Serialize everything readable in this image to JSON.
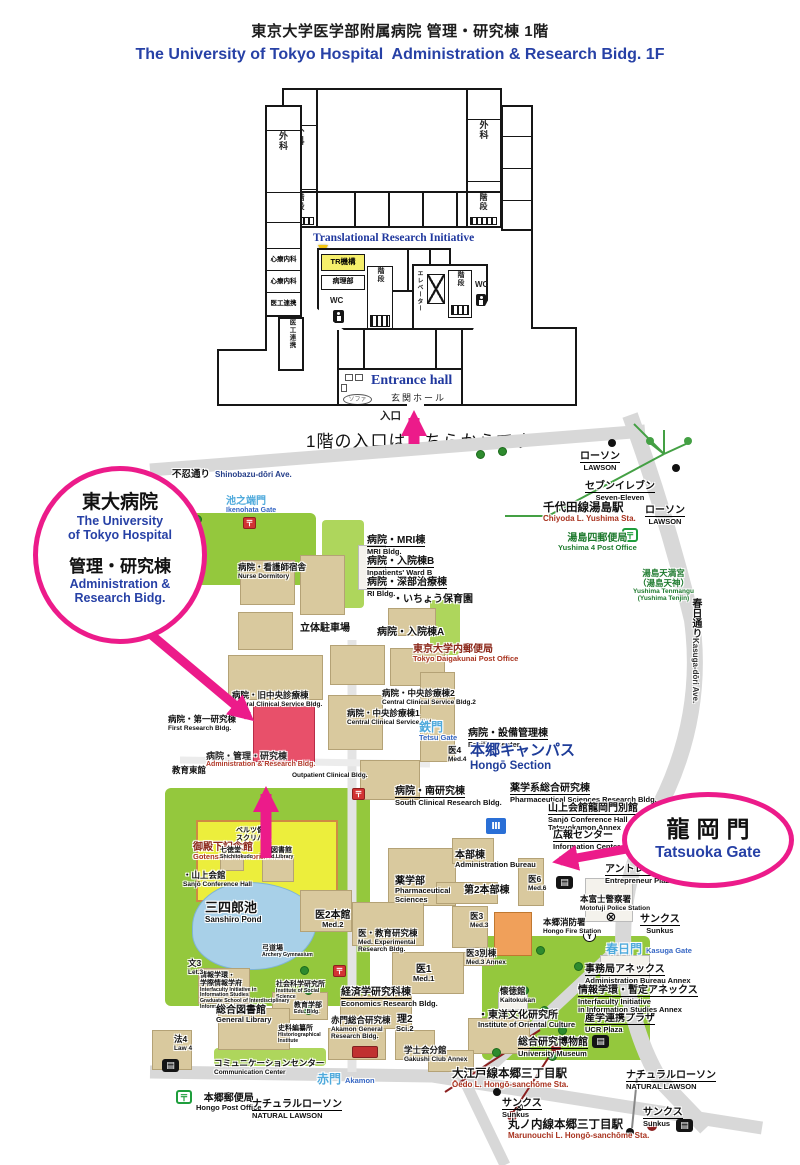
{
  "header": {
    "title_jp": "東京大学医学部附属病院 管理・研究棟 1階",
    "title_en": "The University of Tokyo Hospital  Administration & Research Bidg. 1F"
  },
  "colors": {
    "annotation_pink": "#EC1B8A",
    "highlight_red": "#E8506A",
    "title_blue": "#2741A6",
    "campus_blue": "#1F3D99",
    "gate_lightblue": "#4FAADC"
  },
  "floorplan": {
    "surgery": "外科",
    "stairs": "階段",
    "psychosomatic": "心療内科",
    "med_eng": "医工連携",
    "tri_label": "Translational Research Initiative",
    "tr_room": "TR機構",
    "pathology": "病理部",
    "wc": "WC",
    "elevator": "エレベーター",
    "entrance_en": "Entrance hall",
    "entrance_jp": "玄関ホール",
    "sofa": "ソファ",
    "entry": "入口",
    "note": "1階の入口はこちらからです"
  },
  "annotations": {
    "hospital": {
      "jp1": "東大病院",
      "en1": "The University\nof Tokyo Hospital",
      "jp2": "管理・研究棟",
      "en2": "Administration &\nResearch Bidg."
    },
    "gate": {
      "jp": "龍岡門",
      "en": "Tatsuoka Gate"
    }
  },
  "map": {
    "labels": [
      {
        "jp": "不忍通り",
        "en": "Shinobazu-dōri Ave.",
        "x": 172,
        "y": 464,
        "cls": "road-inline"
      },
      {
        "jp": "ローソン",
        "en": "LAWSON",
        "x": 580,
        "y": 446,
        "cls": "u center"
      },
      {
        "jp": "セブンイレブン",
        "en": "Seven-Eleven",
        "x": 585,
        "y": 476,
        "cls": "u center"
      },
      {
        "jp": "ローソン",
        "en": "LAWSON",
        "x": 645,
        "y": 500,
        "cls": "u center"
      },
      {
        "jp": "千代田線湯島駅",
        "en": "Chiyoda L. Yushima Sta.",
        "x": 543,
        "y": 502,
        "cls": "sta gline"
      },
      {
        "jp": "池之端門",
        "en": "Ikenohata Gate",
        "x": 226,
        "y": 496,
        "cls": "gate-sm"
      },
      {
        "jp": "湯島四郵便局",
        "en": "Yushima 4 Post Office",
        "x": 558,
        "y": 533,
        "cls": "g center"
      },
      {
        "jp": "湯島天満宮\n（湯島天神）",
        "en": "Yushima Tenmangu\n(Yushima Tenjin)",
        "x": 633,
        "y": 569,
        "cls": "g center sm"
      },
      {
        "jp": "春日通り",
        "en": "Kasuga-dōri Ave.",
        "x": 686,
        "y": 598,
        "cls": "vroad"
      },
      {
        "jp": "病院・看護師宿舎",
        "en": "Nurse Dormitory",
        "x": 238,
        "y": 563,
        "cls": "sm"
      },
      {
        "jp": "病院・MRI棟",
        "en": "MRI Bldg.",
        "x": 367,
        "y": 530,
        "cls": "u"
      },
      {
        "jp": "病院・入院棟B",
        "en": "Inpatients' Ward B",
        "x": 367,
        "y": 551,
        "cls": "u"
      },
      {
        "jp": "病院・深部治療棟",
        "en": "RI Bldg.",
        "x": 367,
        "y": 572,
        "cls": "u"
      },
      {
        "jp": "・いちょう保育園",
        "en": "",
        "x": 393,
        "y": 594,
        "cls": ""
      },
      {
        "jp": "立体駐車場",
        "en": "",
        "x": 300,
        "y": 623,
        "cls": ""
      },
      {
        "jp": "病院・入院棟A",
        "en": "",
        "x": 377,
        "y": 627,
        "cls": ""
      },
      {
        "jp": "東京大学内郵便局",
        "en": "Tokyo Daigakunai Post Office",
        "x": 413,
        "y": 644,
        "cls": "dr"
      },
      {
        "jp": "病院・旧中央診療棟",
        "en": "Central Clinical Service Bldg.",
        "x": 232,
        "y": 691,
        "cls": "sm"
      },
      {
        "jp": "病院・第一研究棟",
        "en": "First Research Bldg.",
        "x": 168,
        "y": 715,
        "cls": "sm"
      },
      {
        "jp": "病院・中央診療棟2",
        "en": "Central Clinical Service Bldg.2",
        "x": 382,
        "y": 689,
        "cls": "sm"
      },
      {
        "jp": "病院・中央診療棟1",
        "en": "Central Clinical Service Bldg.",
        "x": 347,
        "y": 709,
        "cls": "sm"
      },
      {
        "jp": "鉄門",
        "en": "Tetsu Gate",
        "x": 419,
        "y": 721,
        "cls": "gate"
      },
      {
        "jp": "病院・設備管理棟",
        "en": "Facility Center",
        "x": 468,
        "y": 723,
        "cls": "u"
      },
      {
        "jp": "医4",
        "en": "Med.4",
        "x": 448,
        "y": 746,
        "cls": "sm"
      },
      {
        "jp": "本郷キャンパス",
        "en": "Hongō Section",
        "x": 470,
        "y": 743,
        "cls": "campus"
      },
      {
        "jp": "教育東館",
        "en": "",
        "x": 172,
        "y": 766,
        "cls": "sm"
      },
      {
        "jp": "病院・管理・研究棟",
        "en": "Administration & Research Bldg.",
        "x": 206,
        "y": 751,
        "cls": "hl"
      },
      {
        "jp": "",
        "en": "Outpatient Clinical Bldg.",
        "x": 292,
        "y": 772,
        "cls": "sm"
      },
      {
        "jp": "病院・南研究棟",
        "en": "South Clinical Research Bldg.",
        "x": 395,
        "y": 781,
        "cls": "u"
      },
      {
        "jp": "薬学系総合研究棟",
        "en": "Pharmaceutical Sciences Research Bldg.",
        "x": 510,
        "y": 778,
        "cls": "u"
      },
      {
        "jp": "山上会館龍岡門別館",
        "en": "Sanjō Conference Hall\nTatsuokamon Annex",
        "x": 548,
        "y": 798,
        "cls": "u"
      },
      {
        "jp": "広報センター",
        "en": "Information Center",
        "x": 553,
        "y": 825,
        "cls": "u"
      },
      {
        "jp": "アントレプレナープラザ",
        "en": "Entrepreneur Plaza",
        "x": 605,
        "y": 859,
        "cls": "u"
      },
      {
        "jp": "本富士警察署",
        "en": "Motofuji Police Station",
        "x": 580,
        "y": 895,
        "cls": "sm"
      },
      {
        "jp": "サンクス",
        "en": "Sunkus",
        "x": 640,
        "y": 909,
        "cls": "u center"
      },
      {
        "jp": "本郷消防署",
        "en": "Hongo Fire Station",
        "x": 543,
        "y": 918,
        "cls": "sm"
      },
      {
        "jp": "春日門",
        "en": "Kasuga Gate",
        "x": 606,
        "y": 940,
        "cls": "gate inline"
      },
      {
        "jp": "御殿下記念館",
        "en": "Gotenshita Memorial Arena",
        "x": 193,
        "y": 842,
        "cls": "dr"
      },
      {
        "jp": "ベルツ像\nスクリバ像",
        "en": "",
        "x": 236,
        "y": 827,
        "cls": "xs"
      },
      {
        "jp": "七徳堂",
        "en": "Shichitokudo",
        "x": 220,
        "y": 847,
        "cls": "xs"
      },
      {
        "jp": "医図書館",
        "en": "Med.Library",
        "x": 264,
        "y": 847,
        "cls": "xs"
      },
      {
        "jp": "・山上会館",
        "en": "Sanjō Conference Hall",
        "x": 183,
        "y": 871,
        "cls": "sm"
      },
      {
        "jp": "三四郎池",
        "en": "Sanshiro Pond",
        "x": 205,
        "y": 901,
        "cls": "big"
      },
      {
        "jp": "医2本館",
        "en": "Med.2",
        "x": 315,
        "y": 910,
        "cls": "center"
      },
      {
        "jp": "弓道場",
        "en": "Archery Gymnasium",
        "x": 262,
        "y": 945,
        "cls": "xs"
      },
      {
        "jp": "薬学部",
        "en": "Pharmaceutical\nSciences",
        "x": 395,
        "y": 876,
        "cls": ""
      },
      {
        "jp": "本部棟",
        "en": "Administration Bureau",
        "x": 455,
        "y": 850,
        "cls": ""
      },
      {
        "jp": "第2本部棟",
        "en": "",
        "x": 464,
        "y": 885,
        "cls": ""
      },
      {
        "jp": "医6",
        "en": "Med.6",
        "x": 528,
        "y": 875,
        "cls": "sm"
      },
      {
        "jp": "医3",
        "en": "Med.3",
        "x": 470,
        "y": 912,
        "cls": "sm"
      },
      {
        "jp": "医3別棟",
        "en": "Med.3 Annex",
        "x": 466,
        "y": 949,
        "cls": "sm"
      },
      {
        "jp": "医1",
        "en": "Med.1",
        "x": 413,
        "y": 964,
        "cls": "center"
      },
      {
        "jp": "医・教育研究棟",
        "en": "Med. Experimental\nResearch Bldg.",
        "x": 358,
        "y": 929,
        "cls": "sm"
      },
      {
        "jp": "経済学研究科棟",
        "en": "Economics Research Bldg.",
        "x": 341,
        "y": 982,
        "cls": "u"
      },
      {
        "jp": "社会科学研究所",
        "en": "Institute of Social\nScience",
        "x": 276,
        "y": 981,
        "cls": "xs"
      },
      {
        "jp": "情報学環・\n学際情報学府",
        "en": "Interfaculty Initiative in\nInformation Studies\nGraduate School of Interdisciplinary\nInformation Studies",
        "x": 200,
        "y": 972,
        "cls": "xs"
      },
      {
        "jp": "文3",
        "en": "Let.3",
        "x": 188,
        "y": 959,
        "cls": "sm"
      },
      {
        "jp": "法4",
        "en": "Law 4",
        "x": 174,
        "y": 1035,
        "cls": "sm"
      },
      {
        "jp": "総合図書館",
        "en": "General Library",
        "x": 216,
        "y": 1005,
        "cls": ""
      },
      {
        "jp": "教育学部",
        "en": "Edu. Bldg.",
        "x": 294,
        "y": 1002,
        "cls": "xs"
      },
      {
        "jp": "史料編纂所",
        "en": "Historiographical\nInstitute",
        "x": 278,
        "y": 1025,
        "cls": "xs"
      },
      {
        "jp": "赤門総合研究棟",
        "en": "Akamon General\nResearch Bldg.",
        "x": 331,
        "y": 1016,
        "cls": "sm"
      },
      {
        "jp": "理2",
        "en": "Sci.2",
        "x": 396,
        "y": 1014,
        "cls": "center"
      },
      {
        "jp": "懐徳館",
        "en": "Kaitokukan",
        "x": 500,
        "y": 987,
        "cls": "sm"
      },
      {
        "jp": "・東洋文化研究所",
        "en": "Institute of Oriental Culture",
        "x": 478,
        "y": 1010,
        "cls": ""
      },
      {
        "jp": "総合研究博物館",
        "en": "University Museum",
        "x": 518,
        "y": 1032,
        "cls": "u"
      },
      {
        "jp": "産学連携プラザ",
        "en": "UCR Plaza",
        "x": 585,
        "y": 1008,
        "cls": "u"
      },
      {
        "jp": "事務局アネックス",
        "en": "Administration Bureau Annex",
        "x": 585,
        "y": 959,
        "cls": "u"
      },
      {
        "jp": "情報学環・暫定アネックス",
        "en": "Interfaculty Initiative\nin Information Studies Annex",
        "x": 578,
        "y": 980,
        "cls": "u"
      },
      {
        "jp": "学士会分館",
        "en": "Gakushi Club Annex",
        "x": 404,
        "y": 1046,
        "cls": "sm"
      },
      {
        "jp": "コミュニケーションセンター",
        "en": "Communication Center",
        "x": 214,
        "y": 1059,
        "cls": "sm"
      },
      {
        "jp": "赤門",
        "en": "Akamon",
        "x": 317,
        "y": 1070,
        "cls": "gate inline"
      },
      {
        "jp": "大江戸線本郷三丁目駅",
        "en": "Ōedo L. Hongō-sanchōme Sta.",
        "x": 452,
        "y": 1068,
        "cls": "sta"
      },
      {
        "jp": "サンクス",
        "en": "Sunkus",
        "x": 502,
        "y": 1093,
        "cls": "u"
      },
      {
        "jp": "丸ノ内線本郷三丁目駅",
        "en": "Marunouchi L. Hongō-sanchōme Sta.",
        "x": 508,
        "y": 1119,
        "cls": "sta"
      },
      {
        "jp": "ナチュラルローソン",
        "en": "NATURAL LAWSON",
        "x": 626,
        "y": 1065,
        "cls": "u"
      },
      {
        "jp": "サンクス",
        "en": "Sunkus",
        "x": 643,
        "y": 1102,
        "cls": "u"
      },
      {
        "jp": "本郷郵便局",
        "en": "Hongo Post Office",
        "x": 196,
        "y": 1093,
        "cls": "center"
      },
      {
        "jp": "ナチュラルローソン",
        "en": "NATURAL LAWSON",
        "x": 252,
        "y": 1094,
        "cls": "u"
      }
    ],
    "icons": [
      {
        "glyph": "〒",
        "type": "post-green",
        "name": "post-office-icon",
        "x": 622,
        "y": 528
      },
      {
        "glyph": "〒",
        "type": "post-green",
        "name": "post-office-icon",
        "x": 176,
        "y": 1090
      },
      {
        "glyph": "〒",
        "type": "post-red",
        "name": "postbox-icon",
        "x": 352,
        "y": 788
      },
      {
        "glyph": "〒",
        "type": "post-red",
        "name": "postbox-icon",
        "x": 333,
        "y": 965
      },
      {
        "glyph": "〒",
        "type": "post-red",
        "name": "postbox-icon",
        "x": 243,
        "y": 517
      },
      {
        "glyph": "⊗",
        "type": "police",
        "name": "police-station-icon",
        "x": 604,
        "y": 910
      },
      {
        "glyph": "Y",
        "type": "fire",
        "name": "fire-station-icon",
        "x": 583,
        "y": 929
      },
      {
        "glyph": "▤",
        "type": "bus",
        "name": "bus-stop-icon",
        "x": 162,
        "y": 1059
      },
      {
        "glyph": "▤",
        "type": "bus",
        "name": "bus-stop-icon",
        "x": 592,
        "y": 1035
      },
      {
        "glyph": "▤",
        "type": "bus",
        "name": "bus-stop-icon",
        "x": 676,
        "y": 1119
      },
      {
        "glyph": "▤",
        "type": "bus",
        "name": "bus-stop-icon",
        "x": 556,
        "y": 876
      },
      {
        "glyph": "Ⅲ",
        "type": "info-blue",
        "name": "information-center-icon",
        "x": 486,
        "y": 818
      }
    ]
  }
}
